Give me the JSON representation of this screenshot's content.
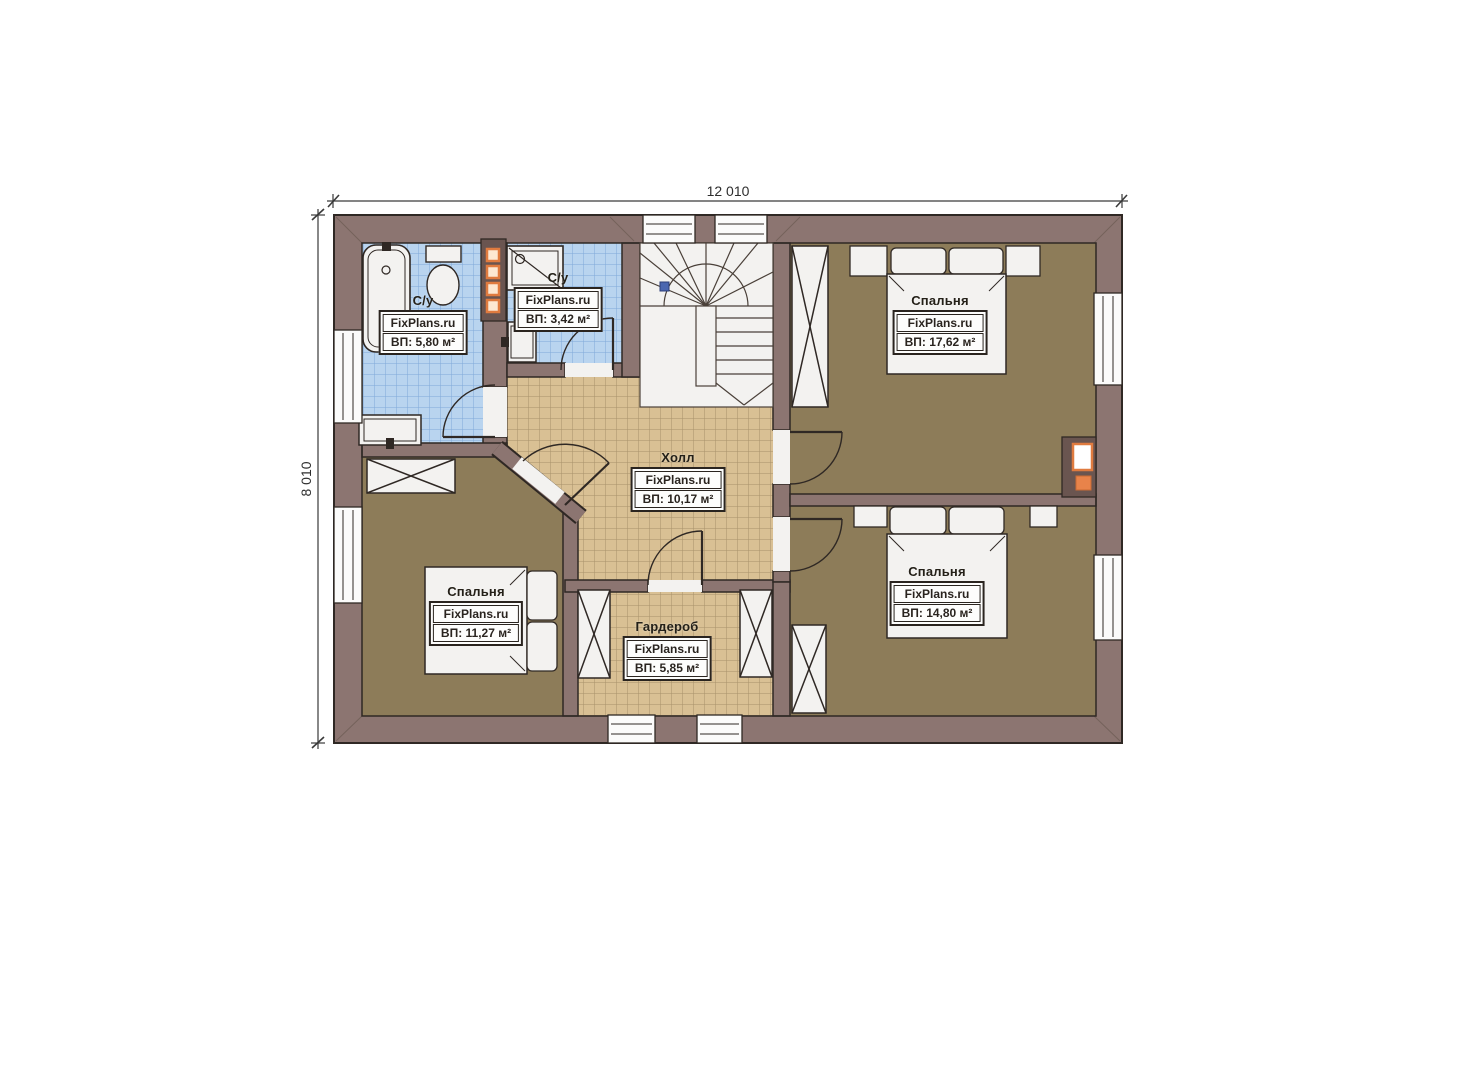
{
  "plan": {
    "brand_watermark": "FixPlans.ru",
    "dimensions": {
      "width": "12 010",
      "height": "8 010"
    },
    "rooms": [
      {
        "id": "bathroom-left",
        "title": "С/у",
        "brand": "FixPlans.ru",
        "area": "ВП: 5,80 м²"
      },
      {
        "id": "bathroom-middle",
        "title": "С/у",
        "brand": "FixPlans.ru",
        "area": "ВП: 3,42 м²"
      },
      {
        "id": "hall",
        "title": "Холл",
        "brand": "FixPlans.ru",
        "area": "ВП: 10,17 м²"
      },
      {
        "id": "bedroom-top-right",
        "title": "Спальня",
        "brand": "FixPlans.ru",
        "area": "ВП: 17,62 м²"
      },
      {
        "id": "bedroom-bottom-right",
        "title": "Спальня",
        "brand": "FixPlans.ru",
        "area": "ВП: 14,80 м²"
      },
      {
        "id": "bedroom-bottom-left",
        "title": "Спальня",
        "brand": "FixPlans.ru",
        "area": "ВП: 11,27 м²"
      },
      {
        "id": "wardrobe",
        "title": "Гардероб",
        "brand": "FixPlans.ru",
        "area": "ВП: 5,85 м²"
      }
    ],
    "colors": {
      "wall": "#8c7571",
      "bedroom_floor": "#8d7c59",
      "hall_tile": "#d9c094",
      "bath_tile": "#b9d4ef",
      "fixture_white": "#f3f2f0",
      "accent_orange": "#e07b3f",
      "outline": "#2f2824"
    }
  }
}
